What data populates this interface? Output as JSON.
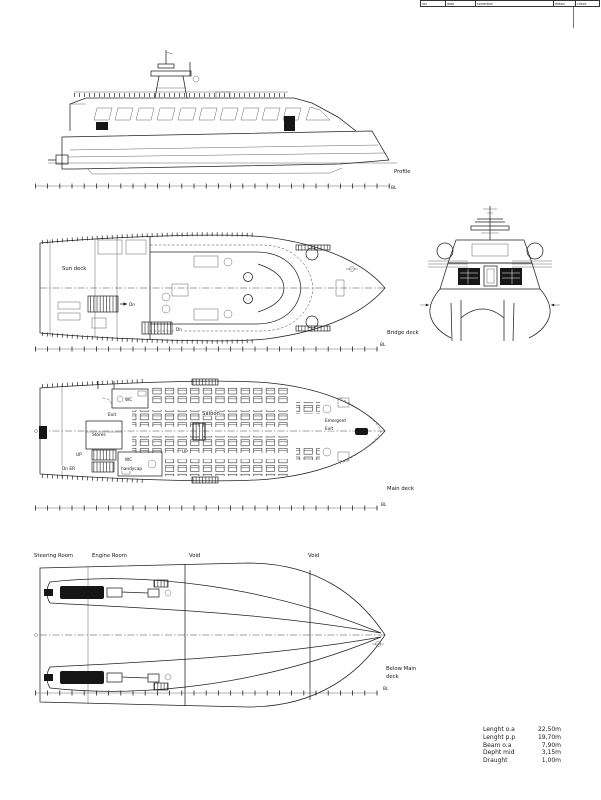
{
  "revision_strip": {
    "cells": [
      "rev",
      "date",
      "correction",
      "drawn",
      "check"
    ]
  },
  "views": {
    "profile": {
      "title": "Profile",
      "baseline": "BL"
    },
    "bridge_deck": {
      "title": "Bridge deck",
      "baseline": "BL",
      "sun_deck": "Sun deck",
      "down_label": "Dn",
      "down_label_2": "Dn"
    },
    "main_deck": {
      "title": "Main deck",
      "baseline": "BL",
      "wc": "WC",
      "exit": "Exit",
      "stores": "Stores",
      "up_aft": "UP",
      "down_engine_room": "Dn ER",
      "wc_handicap_line1": "WC",
      "wc_handicap_line2": "handycap",
      "saloon": "Saloon",
      "up_mid": "UP",
      "emergent_exit_line1": "Emergent",
      "emergent_exit_line2": "Exit"
    },
    "below_main_deck": {
      "title_line1": "Below Main",
      "title_line2": "deck",
      "baseline": "BL",
      "steering_room": "Steering Room",
      "engine_room": "Engine Room",
      "void_1": "Void",
      "void_2": "Void"
    }
  },
  "particulars": {
    "rows": [
      {
        "label": "Lenght o.a",
        "value": "22,50m"
      },
      {
        "label": "Lenght p.p",
        "value": "19,70m"
      },
      {
        "label": "Beam o.a",
        "value": "7,90m"
      },
      {
        "label": "Depht mid",
        "value": "3,15m"
      },
      {
        "label": "Draught",
        "value": "1,00m"
      }
    ]
  },
  "colors": {
    "ink": "#222222",
    "paper": "#ffffff"
  }
}
